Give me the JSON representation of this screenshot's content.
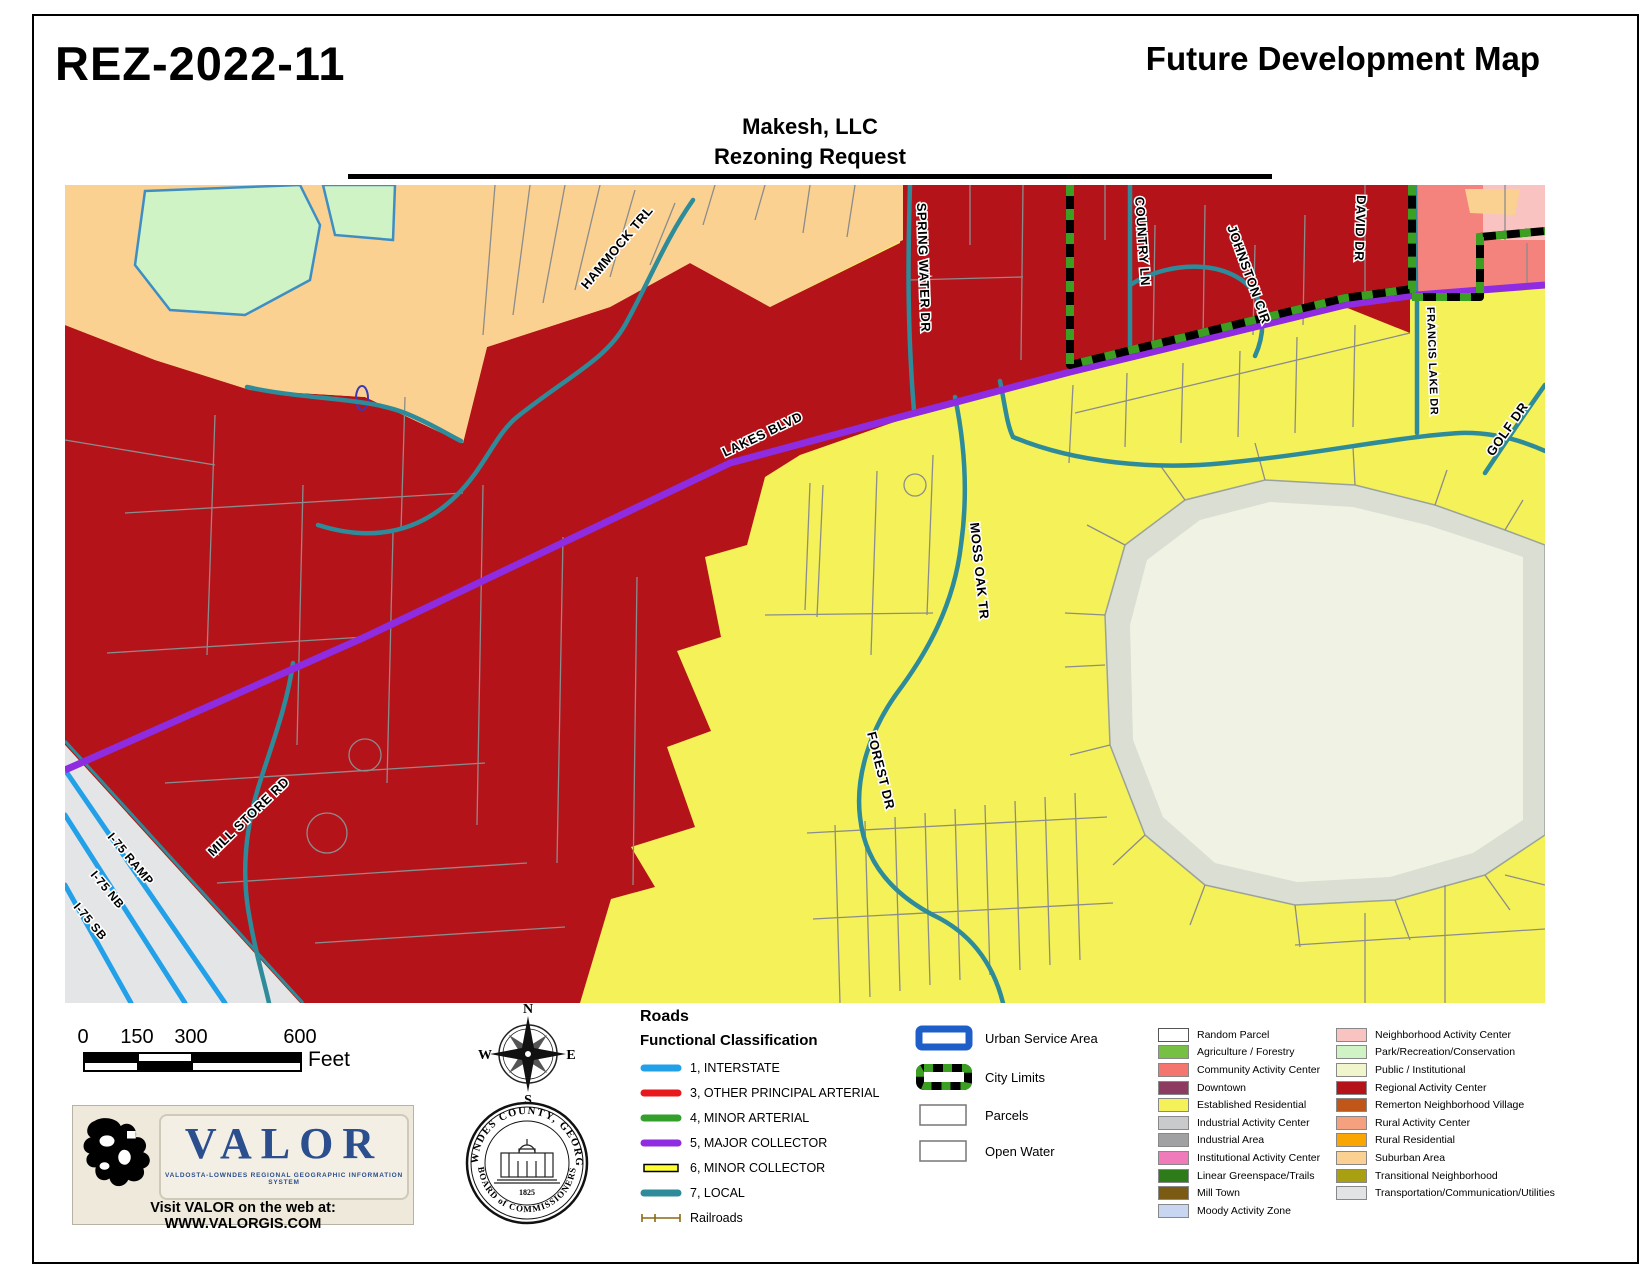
{
  "header": {
    "case_number": "REZ-2022-11",
    "map_title": "Future Development Map",
    "subtitle1": "Makesh, LLC",
    "subtitle2": "Rezoning Request"
  },
  "map": {
    "labels": {
      "hammock": "HAMMOCK TRL",
      "spring_water": "SPRING WATER DR",
      "country_ln": "COUNTRY LN",
      "johnston": "JOHNSTON CIR",
      "david": "DAVID DR",
      "francis": "FRANCIS LAKE DR",
      "golf": "GOLF DR",
      "lakes": "LAKES BLVD",
      "moss_oak": "MOSS OAK TR",
      "forest": "FOREST DR",
      "mill_store": "MILL STORE RD",
      "i75_ramp": "I-75 RAMP",
      "i75_nb": "I-75 NB",
      "i75_sb": "I-75 SB"
    },
    "colors": {
      "local_road": "#2E8B99",
      "interstate": "#22A0E8",
      "major_collector": "#8F2BE0",
      "city_limits_green": "#3BA022"
    }
  },
  "scalebar": {
    "ticks": [
      "0",
      "150",
      "300",
      "600"
    ],
    "unit": "Feet"
  },
  "compass": {
    "n": "N",
    "e": "E",
    "s": "S",
    "w": "W"
  },
  "seal": {
    "arc_top": "LOWNDES COUNTY, GEORGIA",
    "year": "1825",
    "arc_bottom": "BOARD of COMMISSIONERS"
  },
  "valor": {
    "name": "VALOR",
    "tagline": "VALDOSTA-LOWNDES REGIONAL GEOGRAPHIC INFORMATION SYSTEM",
    "web": "Visit VALOR on the web at: WWW.VALORGIS.COM"
  },
  "legend": {
    "roads": {
      "title": "Roads",
      "subtitle": "Functional Classification",
      "items": [
        {
          "label": "1, INTERSTATE",
          "color": "#22A0E8"
        },
        {
          "label": "3, OTHER PRINCIPAL ARTERIAL",
          "color": "#E8191C"
        },
        {
          "label": "4, MINOR ARTERIAL",
          "color": "#33A02C"
        },
        {
          "label": "5, MAJOR COLLECTOR",
          "color": "#8F2BE0"
        },
        {
          "label": "6, MINOR COLLECTOR",
          "color": "#FFFF33"
        },
        {
          "label": "7, LOCAL",
          "color": "#2E8B99"
        },
        {
          "label": "Railroads",
          "color": "#8A6914"
        }
      ]
    },
    "areas": {
      "usa_border": "#1E5EC8",
      "city_green": "#3BA022",
      "city_black": "#000000",
      "items": [
        {
          "label": "Urban Service Area"
        },
        {
          "label": "City Limits"
        },
        {
          "label": "Parcels"
        },
        {
          "label": "Open Water"
        }
      ]
    },
    "landuse_left": [
      {
        "label": "Random Parcel",
        "color": "#FFFFFF"
      },
      {
        "label": "Agriculture / Forestry",
        "color": "#76C043"
      },
      {
        "label": "Community Activity Center",
        "color": "#F4766F"
      },
      {
        "label": "Downtown",
        "color": "#8E3B62"
      },
      {
        "label": "Established Residential",
        "color": "#F5F159"
      },
      {
        "label": "Industrial Activity Center",
        "color": "#C9CACB"
      },
      {
        "label": "Industrial Area",
        "color": "#9FA1A3"
      },
      {
        "label": "Institutional Activity Center",
        "color": "#F07BBB"
      },
      {
        "label": "Linear Greenspace/Trails",
        "color": "#2E7C19"
      },
      {
        "label": "Mill Town",
        "color": "#7B5A14"
      },
      {
        "label": "Moody Activity Zone",
        "color": "#C9D6F2"
      }
    ],
    "landuse_right": [
      {
        "label": "Neighborhood Activity Center",
        "color": "#F8C3C0"
      },
      {
        "label": "Park/Recreation/Conservation",
        "color": "#CFF3C4"
      },
      {
        "label": "Public / Institutional",
        "color": "#F0F5CC"
      },
      {
        "label": "Regional Activity Center",
        "color": "#B5131A"
      },
      {
        "label": "Remerton Neighborhood Village",
        "color": "#C05617"
      },
      {
        "label": "Rural Activity Center",
        "color": "#F5A07E"
      },
      {
        "label": "Rural Residential",
        "color": "#F9A602"
      },
      {
        "label": "Suburban Area",
        "color": "#FAD191"
      },
      {
        "label": "Transitional Neighborhood",
        "color": "#A8A011"
      },
      {
        "label": "Transportation/Communication/Utilities",
        "color": "#E2E3E5"
      }
    ]
  }
}
